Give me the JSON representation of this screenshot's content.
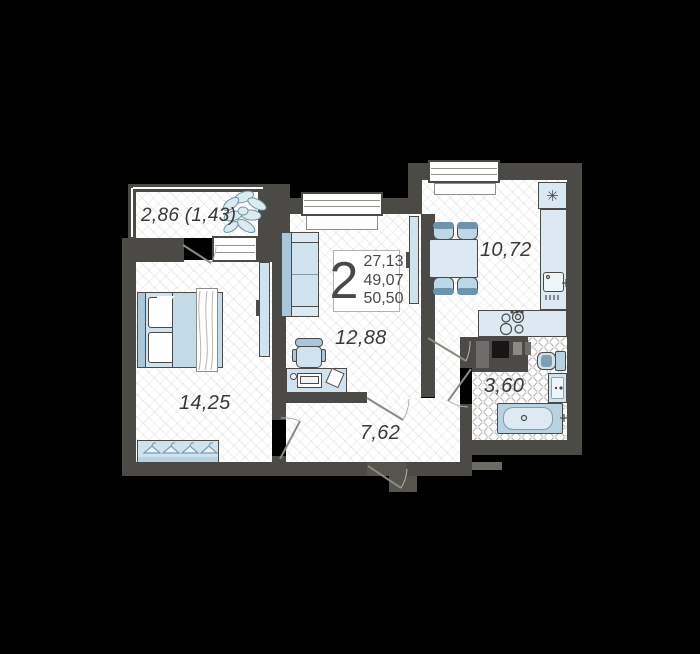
{
  "unit": {
    "rooms_count": "2",
    "areas": [
      "27,13",
      "49,07",
      "50,50"
    ]
  },
  "rooms": {
    "balcony": "2,86 (1,43)",
    "bedroom": "14,25",
    "living": "12,88",
    "hallway": "7,62",
    "kitchen": "10,72",
    "bathroom": "3,60"
  },
  "icons": {
    "fridge": "✳"
  },
  "colors": {
    "background": "#000000",
    "wall": "#4b4a47",
    "furniture_fill": "#cfe2ee",
    "furniture_shade": "#a9c6da",
    "text": "#3a3936"
  }
}
